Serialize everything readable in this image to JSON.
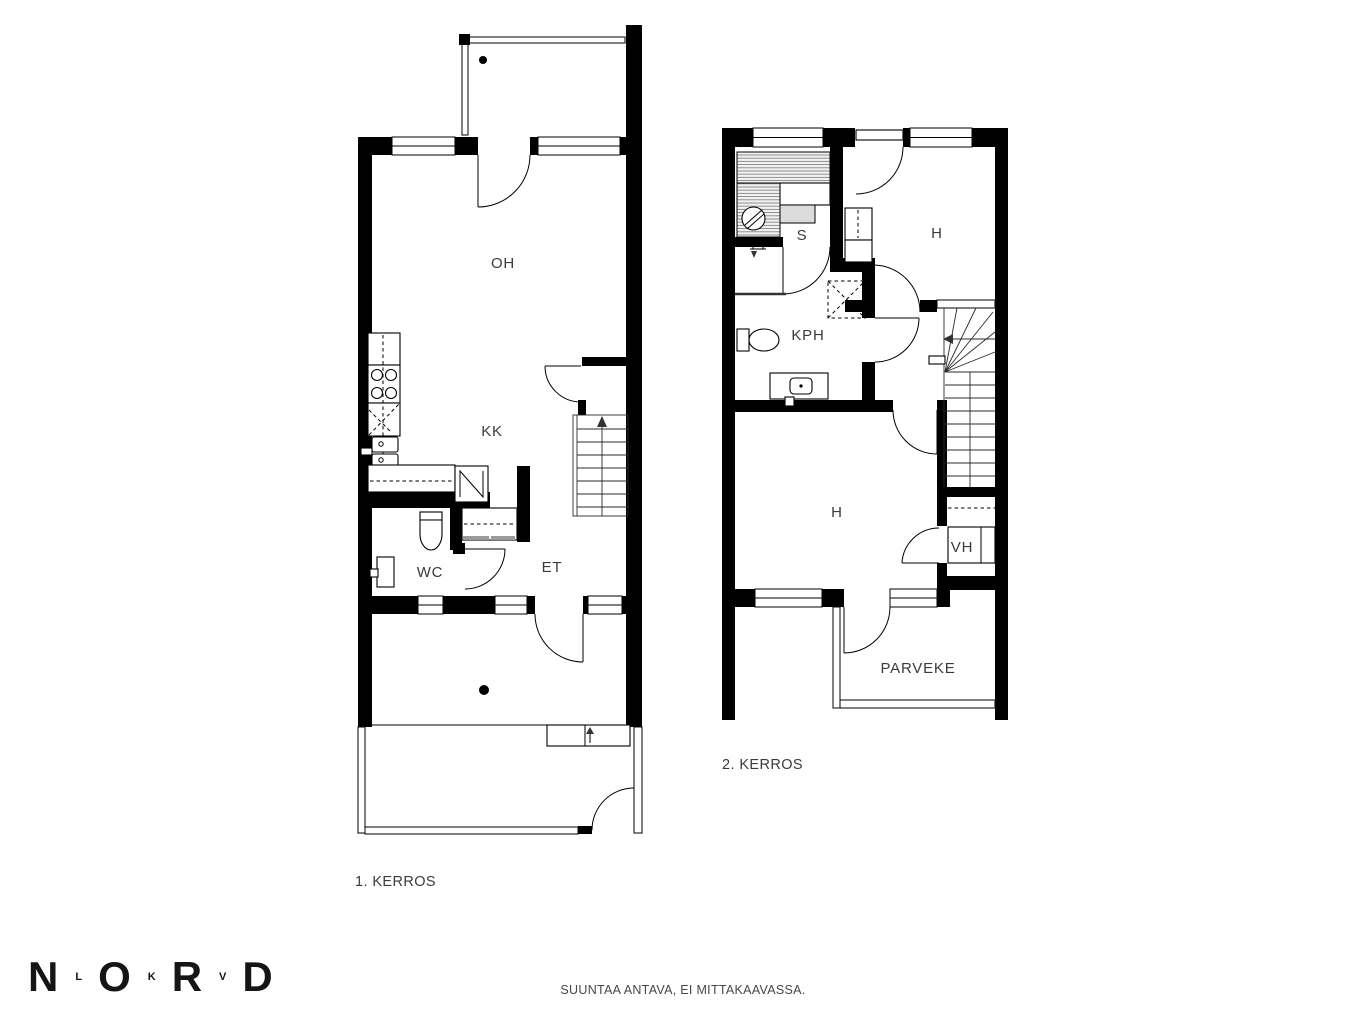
{
  "floor1": {
    "label": "1. KERROS",
    "rooms": {
      "oh": "OH",
      "kk": "KK",
      "wc": "WC",
      "et": "ET"
    }
  },
  "floor2": {
    "label": "2. KERROS",
    "rooms": {
      "s": "S",
      "h_top": "H",
      "kph": "KPH",
      "h_bottom": "H",
      "vh": "VH",
      "parveke": "PARVEKE"
    }
  },
  "footer": {
    "disclaimer": "SUUNTAA ANTAVA, EI MITTAKAAVASSA.",
    "logo_letters": [
      "N",
      "L",
      "O",
      "K",
      "R",
      "V",
      "D"
    ]
  },
  "colors": {
    "wall": "#000000",
    "background": "#ffffff",
    "label": "#3a3a3a"
  }
}
